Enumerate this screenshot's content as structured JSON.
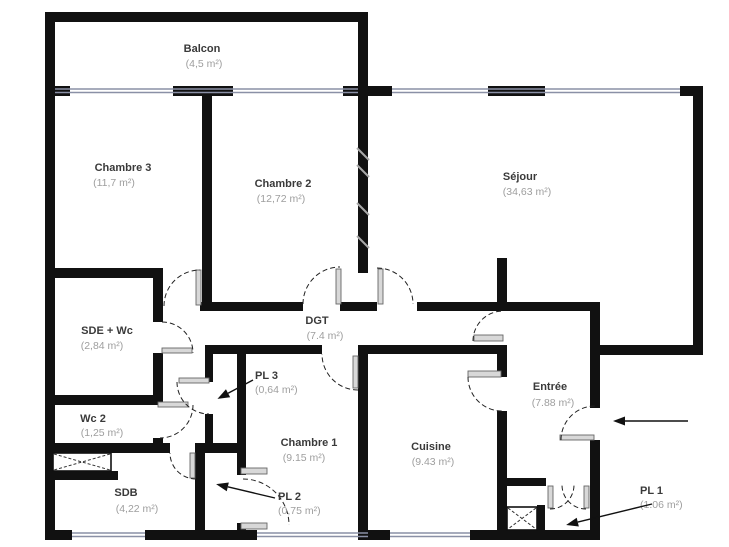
{
  "plan": {
    "type": "apartment-floor-plan",
    "colors": {
      "wall": "#111111",
      "window": "#8a90a6",
      "room_name": "#3a3a3a",
      "room_area": "#9e9e9e",
      "background": "#ffffff"
    },
    "rooms": [
      {
        "name": "Balcon",
        "area": "(4,5 m²)",
        "x": 202,
        "y": 52,
        "ax": 204,
        "ay": 67,
        "anchor": "middle"
      },
      {
        "name": "Chambre 3",
        "area": "(11,7 m²)",
        "x": 123,
        "y": 171,
        "ax": 114,
        "ay": 186,
        "anchor": "middle"
      },
      {
        "name": "Chambre 2",
        "area": "(12,72 m²)",
        "x": 283,
        "y": 187,
        "ax": 281,
        "ay": 202,
        "anchor": "middle"
      },
      {
        "name": "Séjour",
        "area": "(34,63 m²)",
        "x": 520,
        "y": 180,
        "ax": 527,
        "ay": 195,
        "anchor": "middle"
      },
      {
        "name": "SDE + Wc",
        "area": "(2,84 m²)",
        "x": 107,
        "y": 334,
        "ax": 102,
        "ay": 349,
        "anchor": "middle"
      },
      {
        "name": "DGT",
        "area": "(7.4 m²)",
        "x": 317,
        "y": 324,
        "ax": 325,
        "ay": 339,
        "anchor": "middle"
      },
      {
        "name": "Wc 2",
        "area": "(1,25 m²)",
        "x": 93,
        "y": 422,
        "ax": 102,
        "ay": 436,
        "anchor": "middle"
      },
      {
        "name": "PL 3",
        "area": "(0,64 m²)",
        "x": 255,
        "y": 379,
        "ax": 255,
        "ay": 393,
        "anchor": "start"
      },
      {
        "name": "Chambre 1",
        "area": "(9.15 m²)",
        "x": 309,
        "y": 446,
        "ax": 304,
        "ay": 461,
        "anchor": "middle"
      },
      {
        "name": "Cuisine",
        "area": "(9.43 m²)",
        "x": 431,
        "y": 450,
        "ax": 433,
        "ay": 465,
        "anchor": "middle"
      },
      {
        "name": "Entrée",
        "area": "(7.88 m²)",
        "x": 550,
        "y": 390,
        "ax": 553,
        "ay": 406,
        "anchor": "middle"
      },
      {
        "name": "SDB",
        "area": "(4,22 m²)",
        "x": 126,
        "y": 496,
        "ax": 137,
        "ay": 512,
        "anchor": "middle"
      },
      {
        "name": "PL 2",
        "area": "(0,75 m²)",
        "x": 278,
        "y": 500,
        "ax": 278,
        "ay": 514,
        "anchor": "start"
      },
      {
        "name": "PL 1",
        "area": "(1.06 m²)",
        "x": 640,
        "y": 494,
        "ax": 640,
        "ay": 508,
        "anchor": "start"
      }
    ],
    "arrows": [
      {
        "name": "entry-arrow",
        "x1": 688,
        "y1": 421,
        "x2": 617,
        "y2": 421
      },
      {
        "name": "pl3-arrow",
        "x1": 253,
        "y1": 380,
        "x2": 221,
        "y2": 397
      },
      {
        "name": "pl2-arrow",
        "x1": 275,
        "y1": 498,
        "x2": 220,
        "y2": 485
      },
      {
        "name": "pl1-arrow",
        "x1": 652,
        "y1": 504,
        "x2": 570,
        "y2": 524
      }
    ]
  }
}
